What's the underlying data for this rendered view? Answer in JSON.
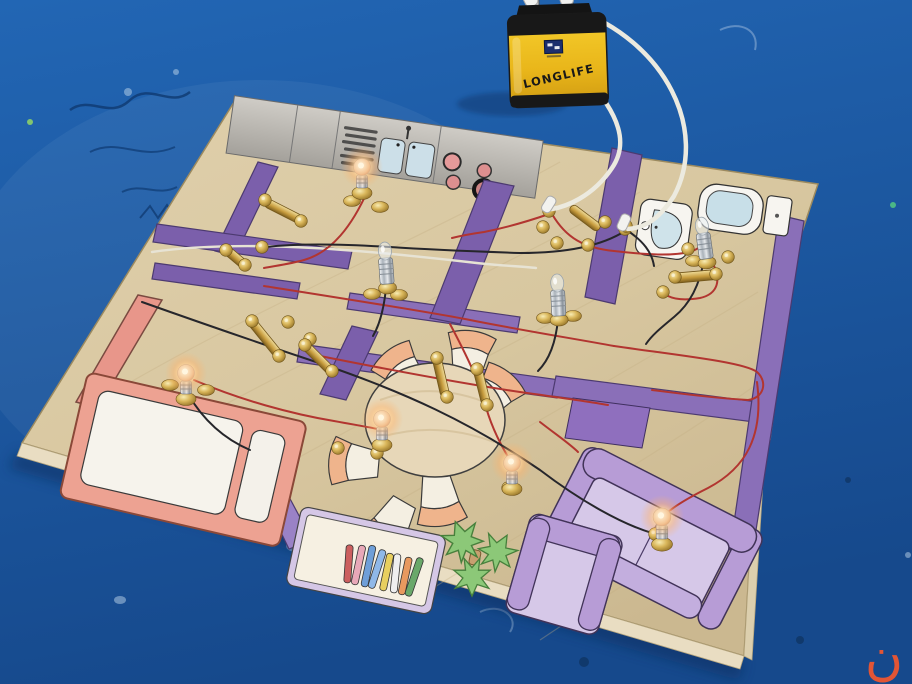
{
  "scene": {
    "battery": {
      "brand_label": "LONGLIFE"
    },
    "watermark": {
      "glyph": "ن"
    },
    "palette": {
      "table_blue": "#2063b2",
      "board_wood": "#d8c7a0",
      "wall_purple": "#7b5fab",
      "wire_red": "#b23530",
      "wire_black": "#26262b",
      "wire_white": "#e7e3d4",
      "battery_yellow": "#eec226",
      "sofa_purple": "#d6c8e8",
      "bed_salmon": "#eda292",
      "bulb_glow": "#ffc887",
      "watermark_orange": "#e25535"
    }
  }
}
